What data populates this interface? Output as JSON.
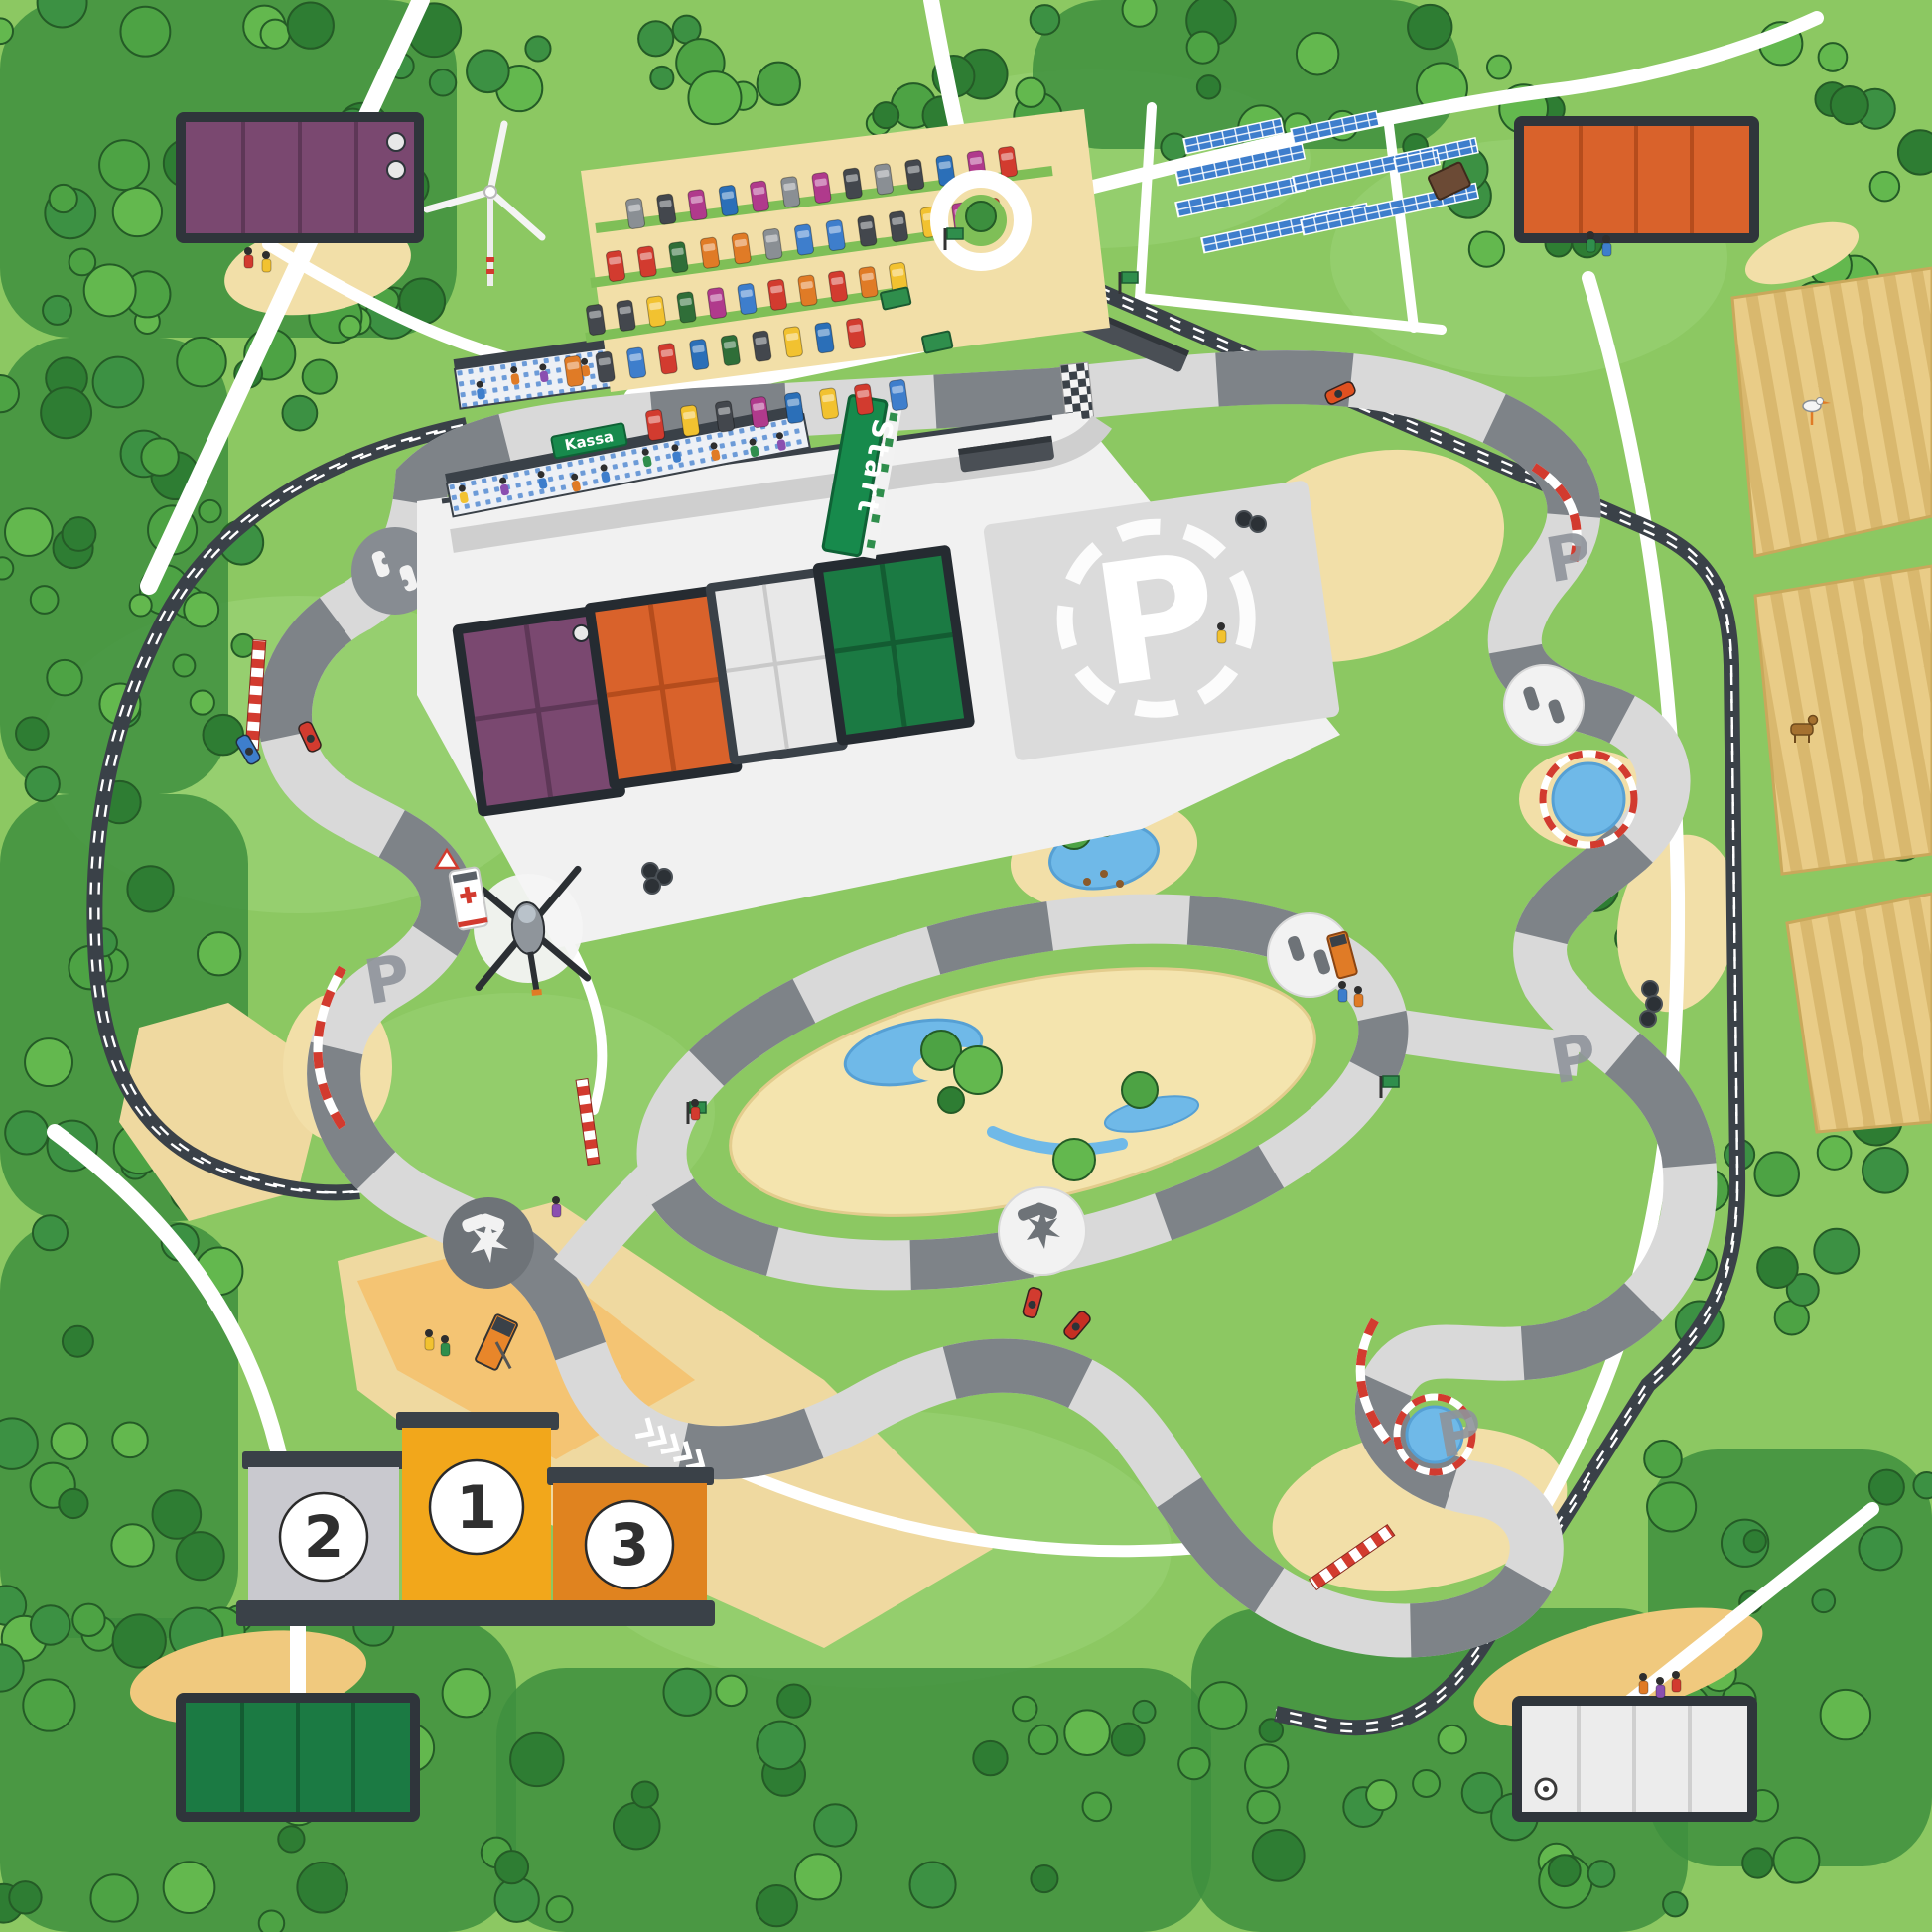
{
  "map": {
    "labels": {
      "start_banner": "Start",
      "ticket_booth": "Kassa",
      "paddock_logo": "P",
      "corner_logo": "P",
      "podium_first": "1",
      "podium_second": "2",
      "podium_third": "3"
    },
    "colors": {
      "grass": "#8CC862",
      "grass_light": "#9CD378",
      "forest": "#3E8F3E",
      "road_white": "#FFFFFF",
      "track_light": "#D9D9D9",
      "track_dark": "#7E8388",
      "rail_dark": "#3A4148",
      "sand": "#F2DFA8",
      "sand_orange": "#F5C06B",
      "field_tan": "#E9CC87",
      "water": "#6FB9E8",
      "building_frame": "#2F353B",
      "building_purple": "#7A4870",
      "building_orange": "#D9622B",
      "building_green": "#1B7A43",
      "building_white": "#ECECEC",
      "paddock_grey": "#DBDBDB",
      "banner_green": "#178A4C",
      "podium_gold": "#F2A71B",
      "podium_silver": "#C9C9CF",
      "podium_bronze": "#E0831F",
      "solar_blue": "#3E7ECC",
      "kerb_red": "#D23B2F"
    }
  },
  "decor": {
    "car_colors": [
      "#D23B2F",
      "#3E7ECC",
      "#8A8F94",
      "#E07B26",
      "#F2C230",
      "#2F6E38",
      "#43474D",
      "#2B6FB8",
      "#B03A8C"
    ],
    "crowd_colors": [
      "#D23B2F",
      "#F2C230",
      "#2F8E4C",
      "#3E7ECC",
      "#E07B26",
      "#8A4FB0"
    ],
    "tree_palette": [
      "#2E7D33",
      "#4DA344",
      "#63B84E",
      "#3C9143"
    ],
    "parking_rows": [
      [
        640,
        215,
        1015,
        163,
        13
      ],
      [
        620,
        268,
        1000,
        215,
        13
      ],
      [
        600,
        322,
        905,
        280,
        11
      ],
      [
        578,
        374,
        862,
        336,
        10
      ],
      [
        660,
        428,
        905,
        398,
        8
      ]
    ],
    "solar_rows": [
      [
        1192,
        140,
        100
      ],
      [
        1300,
        130,
        88
      ],
      [
        1184,
        172,
        130
      ],
      [
        1184,
        204,
        130
      ],
      [
        1302,
        178,
        188
      ],
      [
        1210,
        240,
        170
      ],
      [
        1310,
        222,
        180
      ],
      [
        1404,
        160,
        44
      ]
    ],
    "tree_zones": [
      [
        0,
        0,
        460,
        340,
        30
      ],
      [
        460,
        0,
        330,
        100,
        10
      ],
      [
        1040,
        0,
        430,
        150,
        14
      ],
      [
        1470,
        40,
        130,
        230,
        8
      ],
      [
        1790,
        40,
        156,
        300,
        10
      ],
      [
        0,
        340,
        230,
        460,
        18
      ],
      [
        0,
        800,
        250,
        430,
        16
      ],
      [
        60,
        440,
        240,
        330,
        12
      ],
      [
        0,
        1230,
        240,
        420,
        14
      ],
      [
        0,
        1630,
        520,
        316,
        26
      ],
      [
        500,
        1680,
        720,
        266,
        24
      ],
      [
        1200,
        1620,
        500,
        326,
        22
      ],
      [
        1660,
        1460,
        286,
        420,
        18
      ],
      [
        1840,
        340,
        106,
        560,
        10
      ],
      [
        1700,
        1120,
        200,
        320,
        12
      ],
      [
        250,
        300,
        200,
        120,
        7
      ],
      [
        860,
        30,
        220,
        110,
        7
      ],
      [
        1560,
        850,
        160,
        140,
        5
      ]
    ],
    "grandstand_bands": [
      [
        458,
        372,
        -8,
        590,
        40
      ],
      [
        450,
        487,
        -11,
        366,
        34
      ]
    ],
    "people": [
      [
        250,
        262
      ],
      [
        268,
        266
      ],
      [
        1602,
        246
      ],
      [
        1618,
        250
      ],
      [
        1655,
        1698
      ],
      [
        1672,
        1702
      ],
      [
        1688,
        1696
      ],
      [
        432,
        1352
      ],
      [
        448,
        1358
      ],
      [
        1352,
        1001
      ],
      [
        1368,
        1006
      ],
      [
        560,
        1218
      ],
      [
        700,
        1120
      ],
      [
        1230,
        640
      ]
    ]
  }
}
